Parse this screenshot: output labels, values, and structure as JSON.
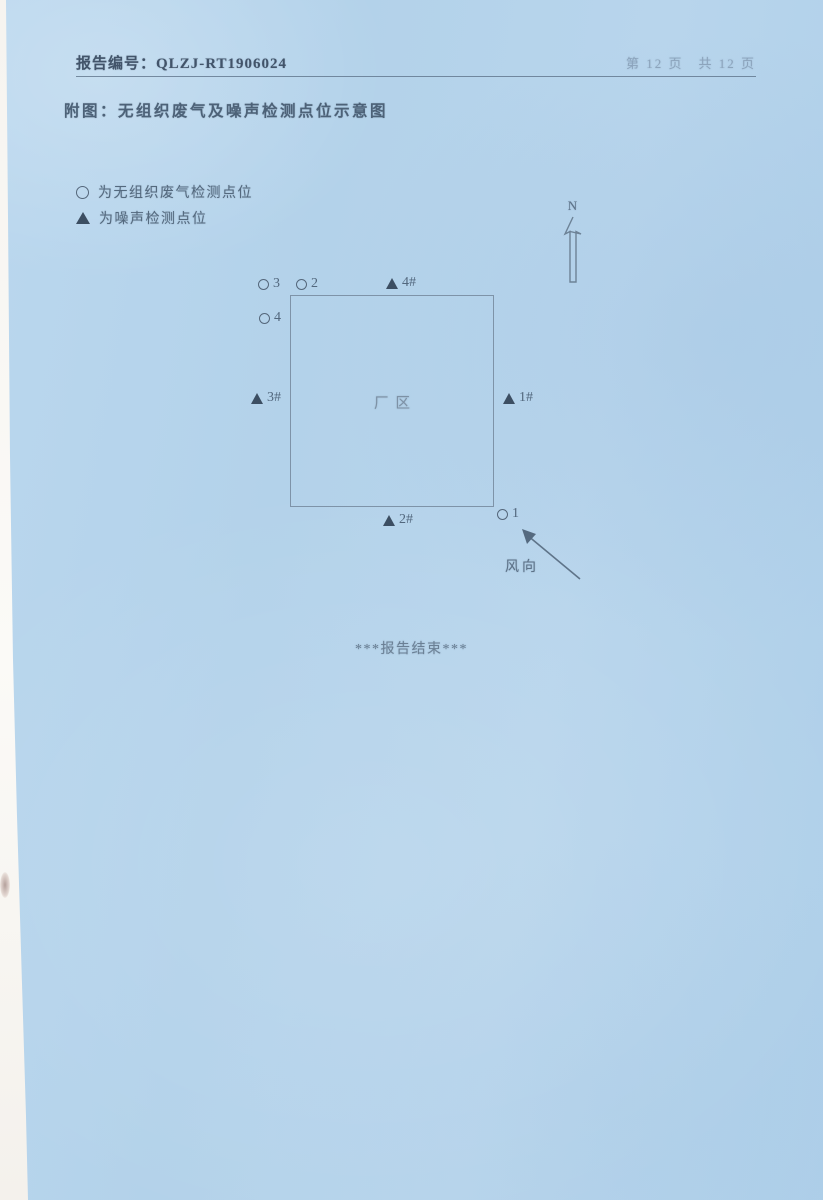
{
  "colors": {
    "paper": "#b5d3eb",
    "scan_edge": "#f8f6f2",
    "ink_dark": "#42546a",
    "ink_medium": "#54697e",
    "ink_faint": "#8ca4bc"
  },
  "header": {
    "report_label": "报告编号：",
    "report_number": "QLZJ-RT1906024",
    "page_info": "第 12 页　共 12 页"
  },
  "title": "附图：无组织废气及噪声检测点位示意图",
  "legend": {
    "items": [
      {
        "marker": "circle",
        "label": "为无组织废气检测点位"
      },
      {
        "marker": "triangle",
        "label": "为噪声检测点位"
      }
    ]
  },
  "diagram": {
    "north_label": "N",
    "area_label": "厂区",
    "wind_label": "风向",
    "points": [
      {
        "id": "gas-point-3",
        "marker": "circle",
        "label": "3"
      },
      {
        "id": "gas-point-2",
        "marker": "circle",
        "label": "2"
      },
      {
        "id": "noise-point-4",
        "marker": "triangle",
        "label": "4#"
      },
      {
        "id": "gas-point-4",
        "marker": "circle",
        "label": "4"
      },
      {
        "id": "noise-point-3",
        "marker": "triangle",
        "label": "3#"
      },
      {
        "id": "noise-point-1",
        "marker": "triangle",
        "label": "1#"
      },
      {
        "id": "noise-point-2",
        "marker": "triangle",
        "label": "2#"
      },
      {
        "id": "gas-point-1",
        "marker": "circle",
        "label": "1"
      }
    ]
  },
  "footer": {
    "end_text": "***报告结束***"
  }
}
